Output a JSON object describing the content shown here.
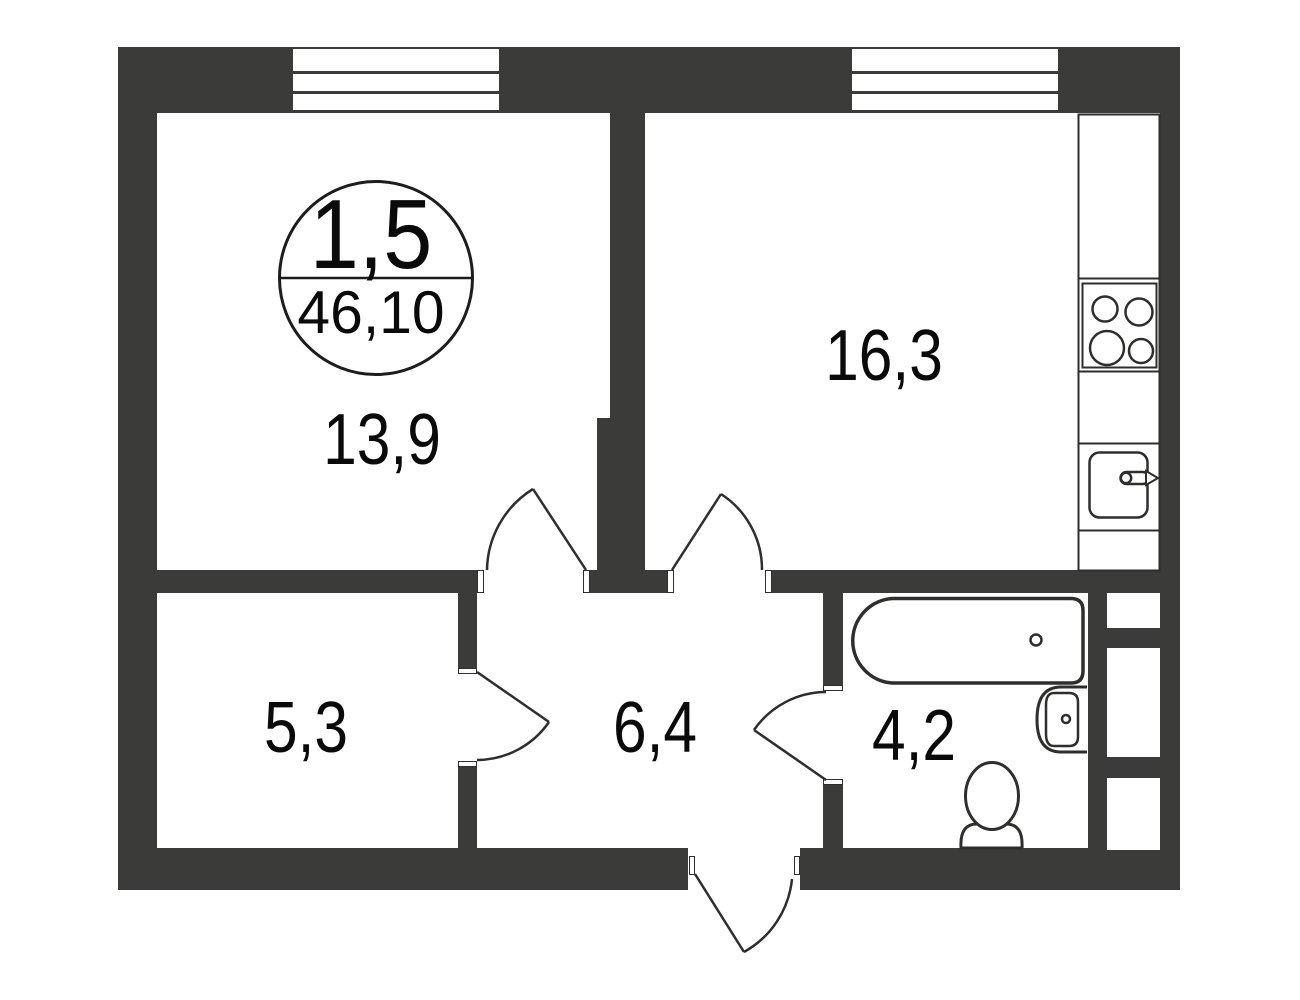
{
  "floor_plan": {
    "stamp": {
      "room_count": "1,5",
      "total_area": "46,10"
    },
    "rooms": [
      {
        "name": "living-room",
        "area": "13,9"
      },
      {
        "name": "kitchen",
        "area": "16,3"
      },
      {
        "name": "storage",
        "area": "5,3"
      },
      {
        "name": "hallway",
        "area": "6,4"
      },
      {
        "name": "bathroom",
        "area": "4,2"
      }
    ],
    "fixtures": [
      "window",
      "window",
      "stove-4-burner",
      "kitchen-sink",
      "bathtub",
      "wash-basin",
      "toilet",
      "ventilation-shaft"
    ],
    "doors": [
      "living-room-door",
      "kitchen-door",
      "storage-door",
      "bathroom-door",
      "entrance-door"
    ],
    "colors": {
      "wall": "#3b3b39",
      "line": "#2e2e2c",
      "background": "#ffffff",
      "text": "#0a0a0a"
    }
  }
}
